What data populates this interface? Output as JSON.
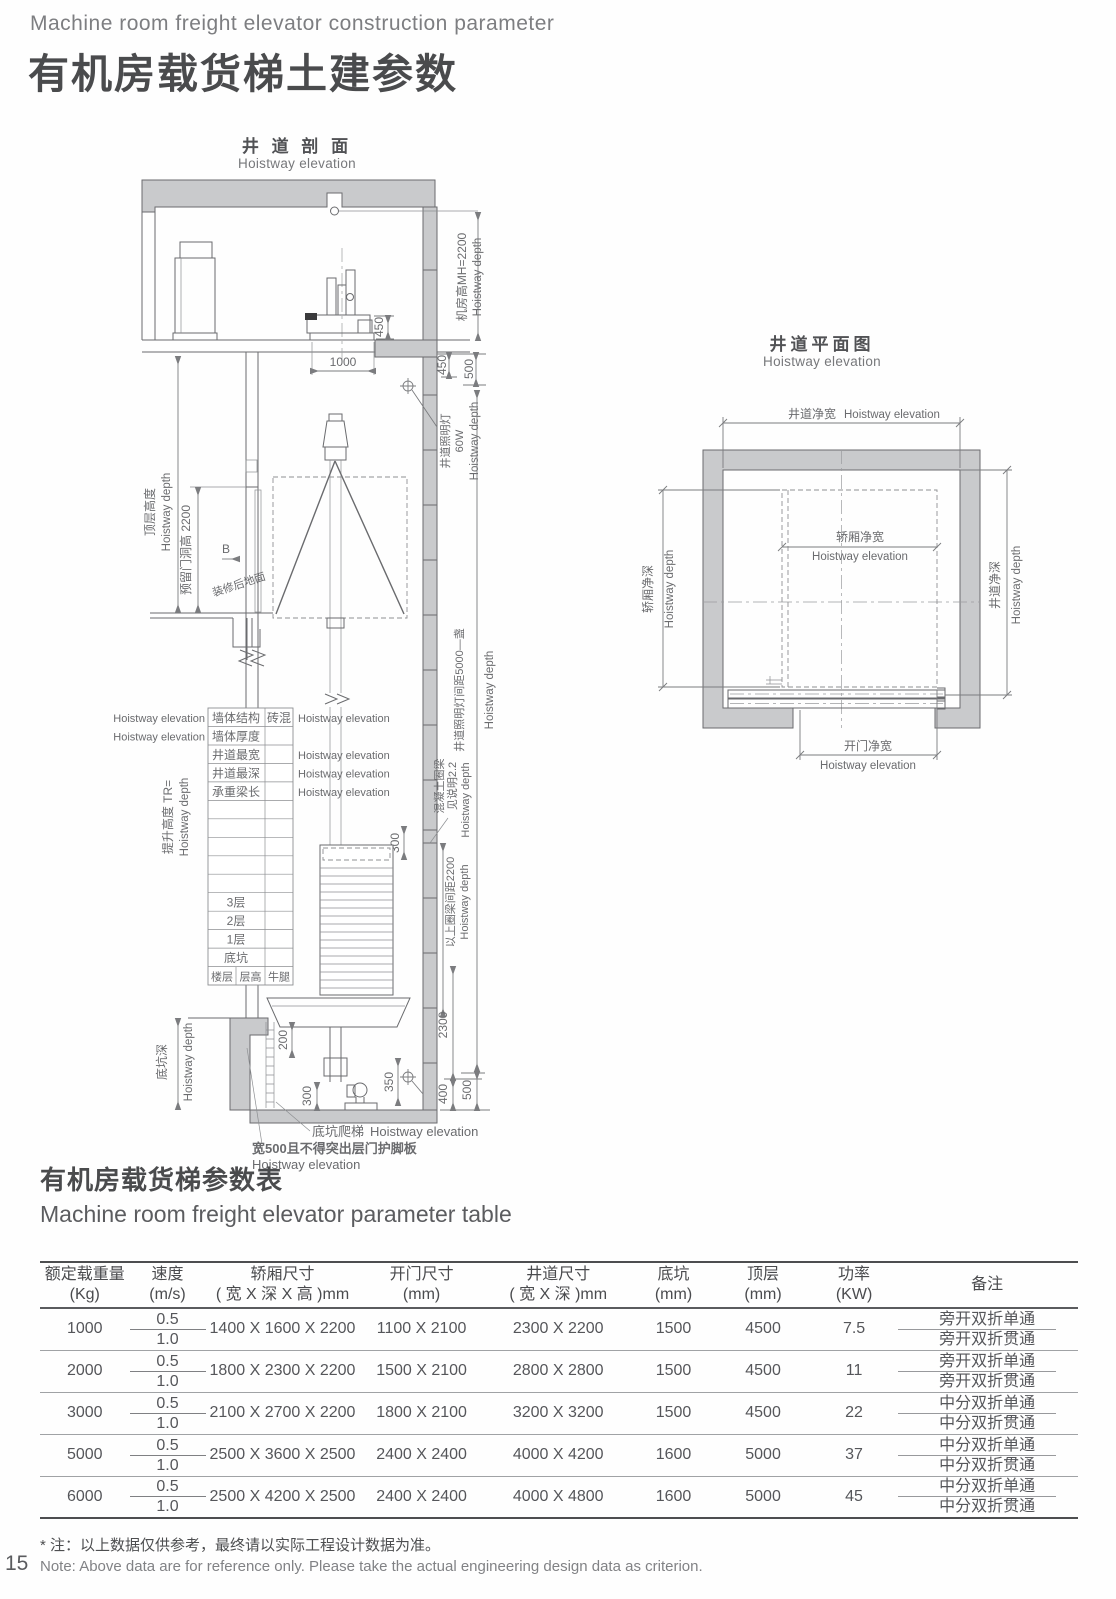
{
  "page": {
    "subtitle_en": "Machine room freight elevator construction parameter",
    "title_zh": "有机房载货梯土建参数",
    "note_zh": "* 注：以上数据仅供参考，最终请以实际工程设计数据为准。",
    "note_en": "Note: Above data are for reference only. Please take the actual engineering design data as criterion.",
    "page_number": "15"
  },
  "elevation": {
    "title_zh": "井 道 剖 面",
    "title_en": "Hoistway elevation",
    "labels": {
      "mh_zh": "机房高MH=2200",
      "mh_en": "Hoistway depth",
      "d450m": "450",
      "d1000": "1000",
      "d450": "450",
      "d500": "500",
      "light_zh": "井道照明灯",
      "light_w": "60W",
      "light_en": "Hoistway depth",
      "topfloor_zh": "顶层高度",
      "topfloor_en": "Hoistway depth",
      "door_zh": "预留门洞高 2200",
      "b_marker": "B",
      "floor_zh": "装修后地面",
      "spacing_zh": "井道照明灯间距5000—盏",
      "spacing_en": "Hoistway depth",
      "ring_zh": "混凝土圈梁",
      "ring_note": "见说明2.2",
      "ring_en": "Hoistway depth",
      "d300r": "300",
      "rs_zh": "以上圈梁间距2200",
      "rs_en": "Hoistway depth",
      "lift_zh": "提升高度 TR=",
      "lift_en": "Hoistway depth",
      "pit_zh": "底坑深",
      "pit_en": "Hoistway depth",
      "d200": "200",
      "d300": "300",
      "d350": "350",
      "d2300": "2300",
      "d400": "400",
      "d500p": "500",
      "ladder_zh": "底坑爬梯",
      "ladder_en": "Hoistway elevation",
      "toe_zh": "宽500且不得突出层门护脚板",
      "toe_en": "Hoistway elevation"
    },
    "spec": {
      "rows": [
        {
          "left": "Hoistway elevation",
          "c1": "墙体结构",
          "c2": "砖混",
          "right": "Hoistway elevation"
        },
        {
          "left": "Hoistway elevation",
          "c1": "墙体厚度",
          "c2": "",
          "right": ""
        },
        {
          "c1": "井道最宽",
          "right": "Hoistway elevation"
        },
        {
          "c1": "井道最深",
          "right": "Hoistway elevation"
        },
        {
          "c1": "承重梁长",
          "right": "Hoistway elevation"
        },
        {},
        {},
        {},
        {},
        {},
        {
          "c1": "3层"
        },
        {
          "c1": "2层"
        },
        {
          "c1": "1层"
        },
        {
          "c1": "底坑"
        },
        {
          "c1": "楼层",
          "c2": "层高",
          "c3": "牛腿"
        }
      ]
    }
  },
  "plan": {
    "title_zh": "井道平面图",
    "title_en": "Hoistway elevation",
    "labels": {
      "sw_zh": "井道净宽",
      "sw_en": "Hoistway elevation",
      "cw_zh": "轿厢净宽",
      "cw_en": "Hoistway elevation",
      "cd_zh": "轿厢净深",
      "cd_en": "Hoistway depth",
      "sd_zh": "井道净深",
      "sd_en": "Hoistway depth",
      "dw_zh": "开门净宽",
      "dw_en": "Hoistway elevation"
    }
  },
  "param_table": {
    "title_zh": "有机房载货梯参数表",
    "title_en": "Machine room freight elevator parameter table",
    "headers": [
      {
        "l1": "额定载重量",
        "l2": "(Kg)"
      },
      {
        "l1": "速度",
        "l2": "(m/s)"
      },
      {
        "l1": "轿厢尺寸",
        "l2": "( 宽 X 深 X 高 )mm"
      },
      {
        "l1": "开门尺寸",
        "l2": "(mm)"
      },
      {
        "l1": "井道尺寸",
        "l2": "( 宽 X 深 )mm"
      },
      {
        "l1": "底坑",
        "l2": "(mm)"
      },
      {
        "l1": "顶层",
        "l2": "(mm)"
      },
      {
        "l1": "功率",
        "l2": "(KW)"
      },
      {
        "l1": "备注",
        "l2": ""
      }
    ],
    "rows": [
      {
        "load": "1000",
        "speed_1": "0.5",
        "speed_2": "1.0",
        "car": "1400 X 1600 X 2200",
        "door": "1100 X 2100",
        "shaft": "2300 X 2200",
        "pit": "1500",
        "overhead": "4500",
        "power": "7.5",
        "remark_1": "旁开双折单通",
        "remark_2": "旁开双折贯通"
      },
      {
        "load": "2000",
        "speed_1": "0.5",
        "speed_2": "1.0",
        "car": "1800 X 2300 X 2200",
        "door": "1500 X 2100",
        "shaft": "2800 X 2800",
        "pit": "1500",
        "overhead": "4500",
        "power": "11",
        "remark_1": "旁开双折单通",
        "remark_2": "旁开双折贯通"
      },
      {
        "load": "3000",
        "speed_1": "0.5",
        "speed_2": "1.0",
        "car": "2100 X 2700 X 2200",
        "door": "1800 X 2100",
        "shaft": "3200 X 3200",
        "pit": "1500",
        "overhead": "4500",
        "power": "22",
        "remark_1": "中分双折单通",
        "remark_2": "中分双折贯通"
      },
      {
        "load": "5000",
        "speed_1": "0.5",
        "speed_2": "1.0",
        "car": "2500 X 3600 X 2500",
        "door": "2400 X 2400",
        "shaft": "4000 X 4200",
        "pit": "1600",
        "overhead": "5000",
        "power": "37",
        "remark_1": "中分双折单通",
        "remark_2": "中分双折贯通"
      },
      {
        "load": "6000",
        "speed_1": "0.5",
        "speed_2": "1.0",
        "car": "2500 X 4200 X 2500",
        "door": "2400 X 2400",
        "shaft": "4000 X 4800",
        "pit": "1600",
        "overhead": "5000",
        "power": "45",
        "remark_1": "中分双折单通",
        "remark_2": "中分双折贯通"
      }
    ]
  }
}
